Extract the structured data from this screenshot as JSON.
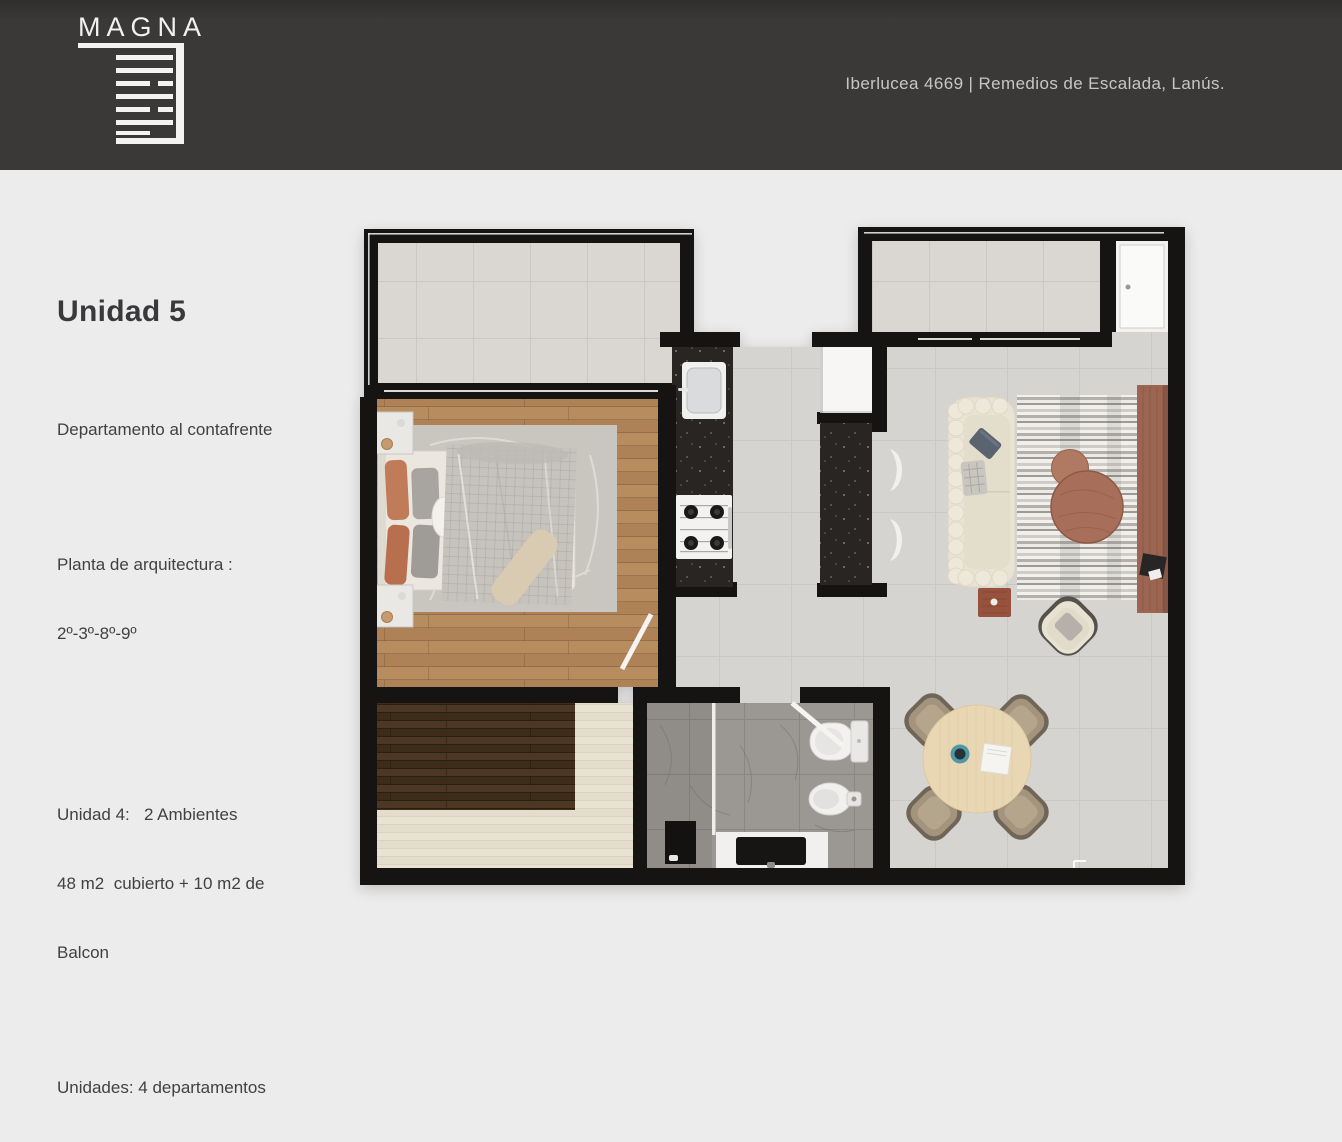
{
  "header": {
    "brand": "MAGNA",
    "address": "Iberlucea 4669 | Remedios de Escalada, Lanús.",
    "bg_color": "#3b3838",
    "text_color": "#c8c6c5"
  },
  "info_panel": {
    "title": "Unidad 5",
    "subtitle": "Departamento al contafrente",
    "plant_label": "Planta de arquitectura :",
    "plant_floors": "2º-3º-8º-9º",
    "unit_line": "Unidad 4:   2 Ambientes",
    "area_line1": "48 m2  cubierto + 10 m2 de",
    "area_line2": "Balcon",
    "units_line": "Unidades: 4 departamentos"
  },
  "floor_plan": {
    "unit": "5",
    "rooms": [
      "front-balcony",
      "bedroom",
      "kitchen",
      "entry-hall",
      "living-dining",
      "bathroom",
      "rear-balcony",
      "storage-closet",
      "terrace"
    ],
    "colors": {
      "walls": "#161412",
      "wood_floor": "#b38a5e",
      "deck_dark": "#46331f",
      "deck_cream": "#e7e1d3",
      "balcony_tile": "#dad6d1",
      "living_tile": "#d5d4d1",
      "bath_tile": "#9b9792",
      "counter_marble": "#282522",
      "sofa": "#e9e3d4",
      "table_wood": "#e9d7b4",
      "accent_terracotta": "#a76f59"
    }
  }
}
